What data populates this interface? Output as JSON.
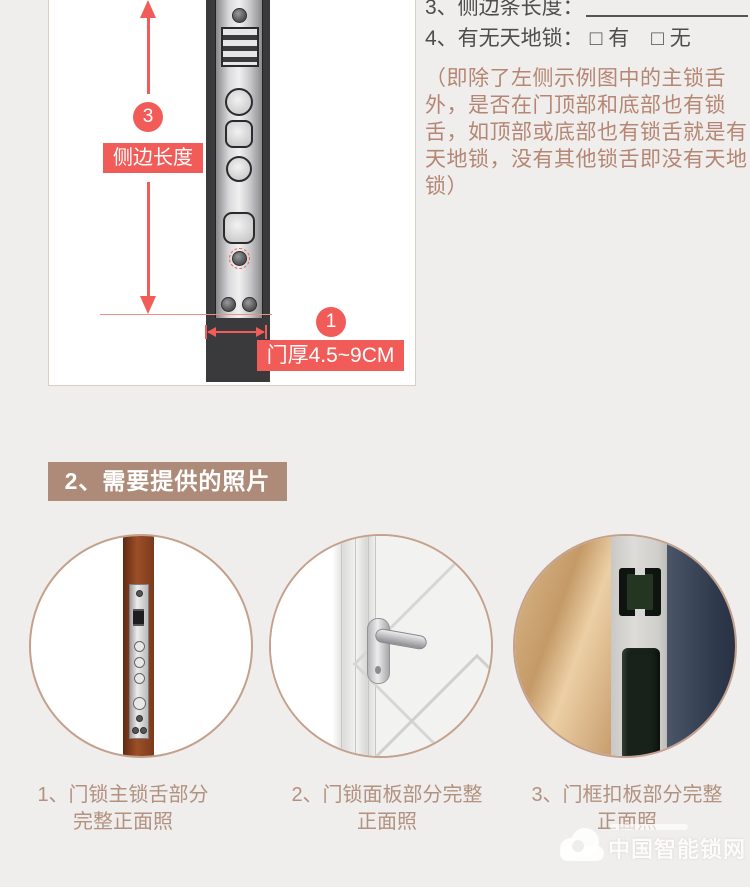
{
  "colors": {
    "page_bg": "#efeeec",
    "accent_red": "#f25c58",
    "heading_bg": "#ae8b78",
    "caption_text": "#b29180",
    "note_text": "#b58673",
    "door_dark": "#3a3a3c"
  },
  "measure": {
    "badge_side": "3",
    "side_length_label": "侧边长度",
    "badge_thickness": "1",
    "thickness_label": "门厚4.5~9CM",
    "item3_label": "3、侧边条长度：",
    "item4_label": "4、有无天地锁：",
    "option_yes": "□ 有",
    "option_no": "□ 无",
    "note": "（即除了左侧示例图中的主锁舌外，是否在门顶部和底部也有锁舌，如顶部或底部也有锁舌就是有天地锁，没有其他锁舌即没有天地锁）"
  },
  "photos": {
    "heading": "2、需要提供的照片",
    "items": [
      {
        "line1": "1、门锁主锁舌部分",
        "line2": "完整正面照"
      },
      {
        "line1": "2、门锁面板部分完整",
        "line2": "正面照"
      },
      {
        "line1": "3、门框扣板部分完整",
        "line2": "正面照"
      }
    ]
  },
  "watermark": {
    "text": "中国智能锁网"
  }
}
